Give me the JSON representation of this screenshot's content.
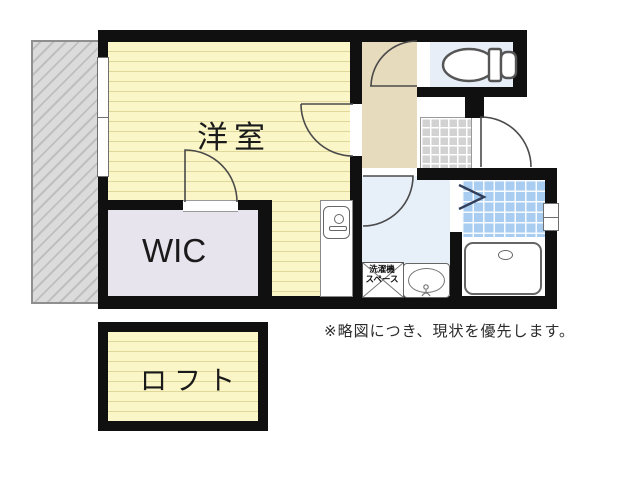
{
  "plan": {
    "rooms": {
      "main_room": {
        "label": "洋室"
      },
      "wic": {
        "label": "WIC"
      },
      "loft": {
        "label": "ロフト"
      }
    },
    "washer_space": {
      "line1": "洗濯機",
      "line2": "スペース"
    },
    "note": "※略図につき、現状を優先します。"
  },
  "colors": {
    "wall": "#101010",
    "room_floor": "#fbf6c7",
    "wic_floor": "#e8e4ee",
    "hallway_floor": "#e7dbbd",
    "toilet_floor": "#e7eef8",
    "washroom_floor": "#e7eff9",
    "bath_tile": "#a9cdf0",
    "genkan_tile": "#d2d2d2",
    "balcony": "#dbdbdb"
  }
}
